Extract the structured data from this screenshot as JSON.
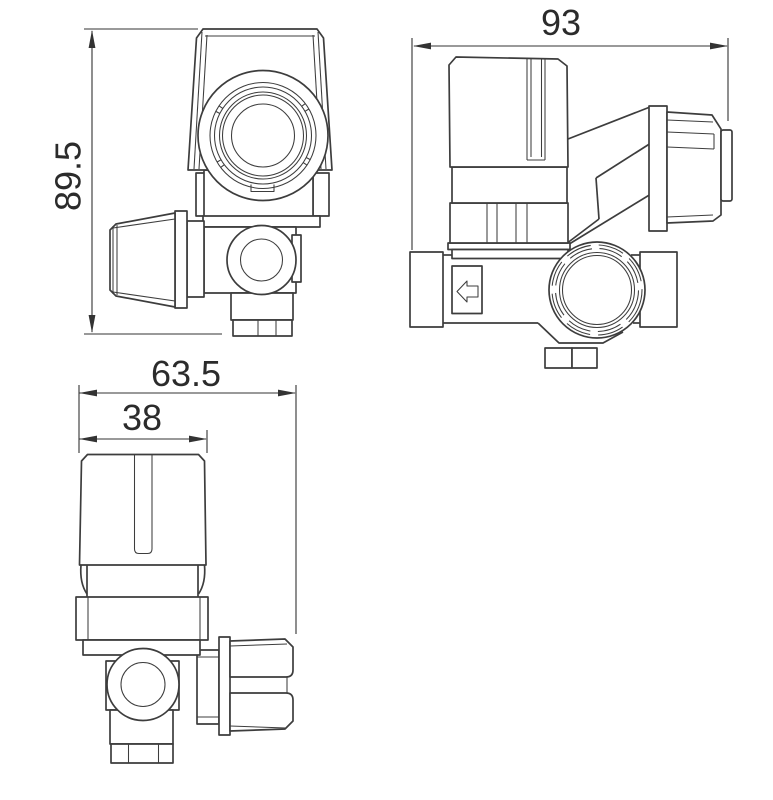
{
  "canvas": {
    "width": 773,
    "height": 800,
    "background": "#ffffff"
  },
  "style": {
    "line_color": "#3d3d3d",
    "dimline_color": "#333333",
    "text_color": "#2b2b2b"
  },
  "views": {
    "top_view": {
      "dims": {
        "height": {
          "label": "89.5",
          "orientation": "vertical"
        }
      }
    },
    "side_view": {
      "dims": {
        "width": {
          "label": "93",
          "orientation": "horizontal"
        }
      },
      "icons": {
        "flow_arrow": "left-arrow-icon"
      }
    },
    "front_view": {
      "dims": {
        "overall_width": {
          "label": "63.5",
          "orientation": "horizontal"
        },
        "knob_width": {
          "label": "38",
          "orientation": "horizontal"
        }
      }
    }
  }
}
